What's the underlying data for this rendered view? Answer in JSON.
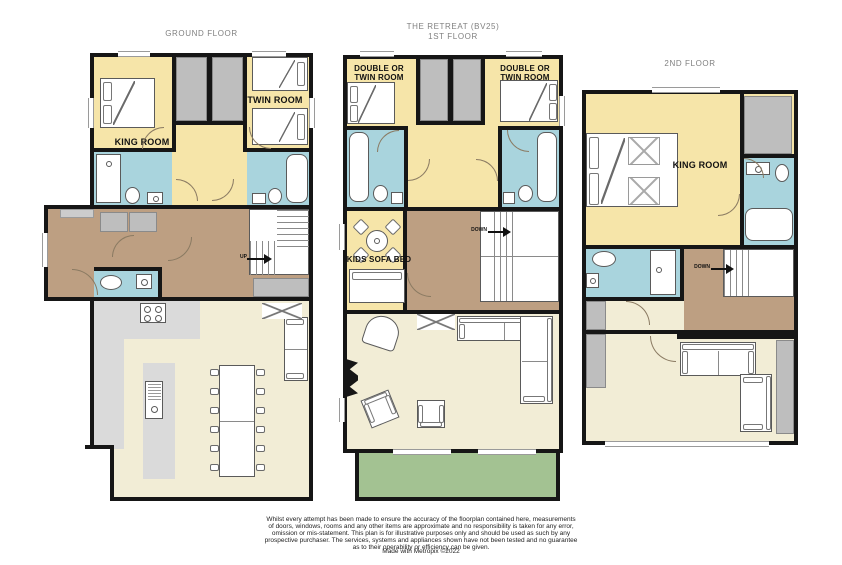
{
  "palette": {
    "wall": "#161616",
    "bedroom": "#f6e5a9",
    "bathroom": "#a9d4dd",
    "hall": "#bd9f82",
    "floor": "#f2edd6",
    "counter": "#dadada",
    "wardrobe": "#bebebe",
    "balcony": "#a3c292",
    "title_text": "#808080",
    "label_text": "#111111"
  },
  "floors": {
    "ground": {
      "title": "GROUND FLOOR",
      "rooms": {
        "king": "KING ROOM",
        "twin": "TWIN ROOM"
      },
      "stairs": {
        "up": "UP"
      }
    },
    "first": {
      "title_lines": [
        "THE RETREAT (BV25)",
        "1ST FLOOR"
      ],
      "rooms": {
        "double_left": [
          "DOUBLE OR",
          "TWIN ROOM"
        ],
        "double_right": [
          "DOUBLE OR",
          "TWIN ROOM"
        ],
        "kids": "KIDS SOFA BED"
      },
      "stairs": {
        "down": "DOWN"
      }
    },
    "second": {
      "title": "2ND FLOOR",
      "rooms": {
        "king": "KING ROOM"
      },
      "stairs": {
        "down": "DOWN"
      }
    }
  },
  "footer": {
    "disclaimer": [
      "Whilst every attempt has been made to ensure the accuracy of the floorplan contained here, measurements",
      "of doors, windows, rooms and any other items are approximate and no responsibility is taken for any error,",
      "omission or mis-statement. This plan is for illustrative purposes only and should be used as such by any",
      "prospective purchaser. The services, systems and appliances shown have not been tested and no guarantee",
      "as to their operability or efficiency can be given."
    ],
    "credit": "Made with Metropix ©2022"
  }
}
